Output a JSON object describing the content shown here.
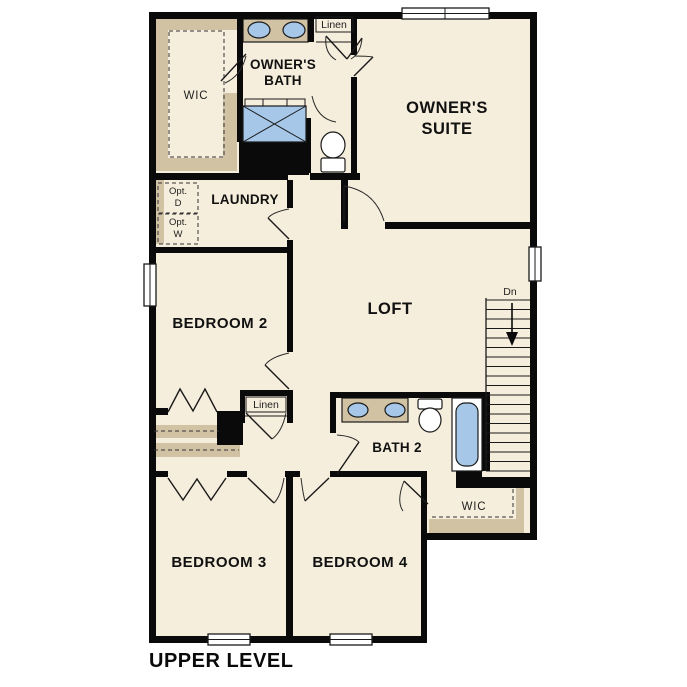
{
  "colors": {
    "wall": "#0a0a0a",
    "floor": "#f6eedc",
    "tan": "#d2c2a4",
    "fixture_blue": "#a6c7e7",
    "opt_gray": "#e0e0e0",
    "white": "#ffffff"
  },
  "labels": {
    "wic_top": "WIC",
    "owners_bath_1": "OWNER'S",
    "owners_bath_2": "BATH",
    "linen_top": "Linen",
    "owners_suite_1": "OWNER'S",
    "owners_suite_2": "SUITE",
    "laundry": "LAUNDRY",
    "opt_d_1": "Opt.",
    "opt_d_2": "D",
    "opt_w_1": "Opt.",
    "opt_w_2": "W",
    "bedroom2": "BEDROOM 2",
    "loft": "LOFT",
    "stairs_down": "Dn",
    "linen_mid": "Linen",
    "bath2": "BATH 2",
    "wic_bottom": "WIC",
    "bedroom3": "BEDROOM 3",
    "bedroom4": "BEDROOM 4",
    "caption": "UPPER LEVEL"
  }
}
